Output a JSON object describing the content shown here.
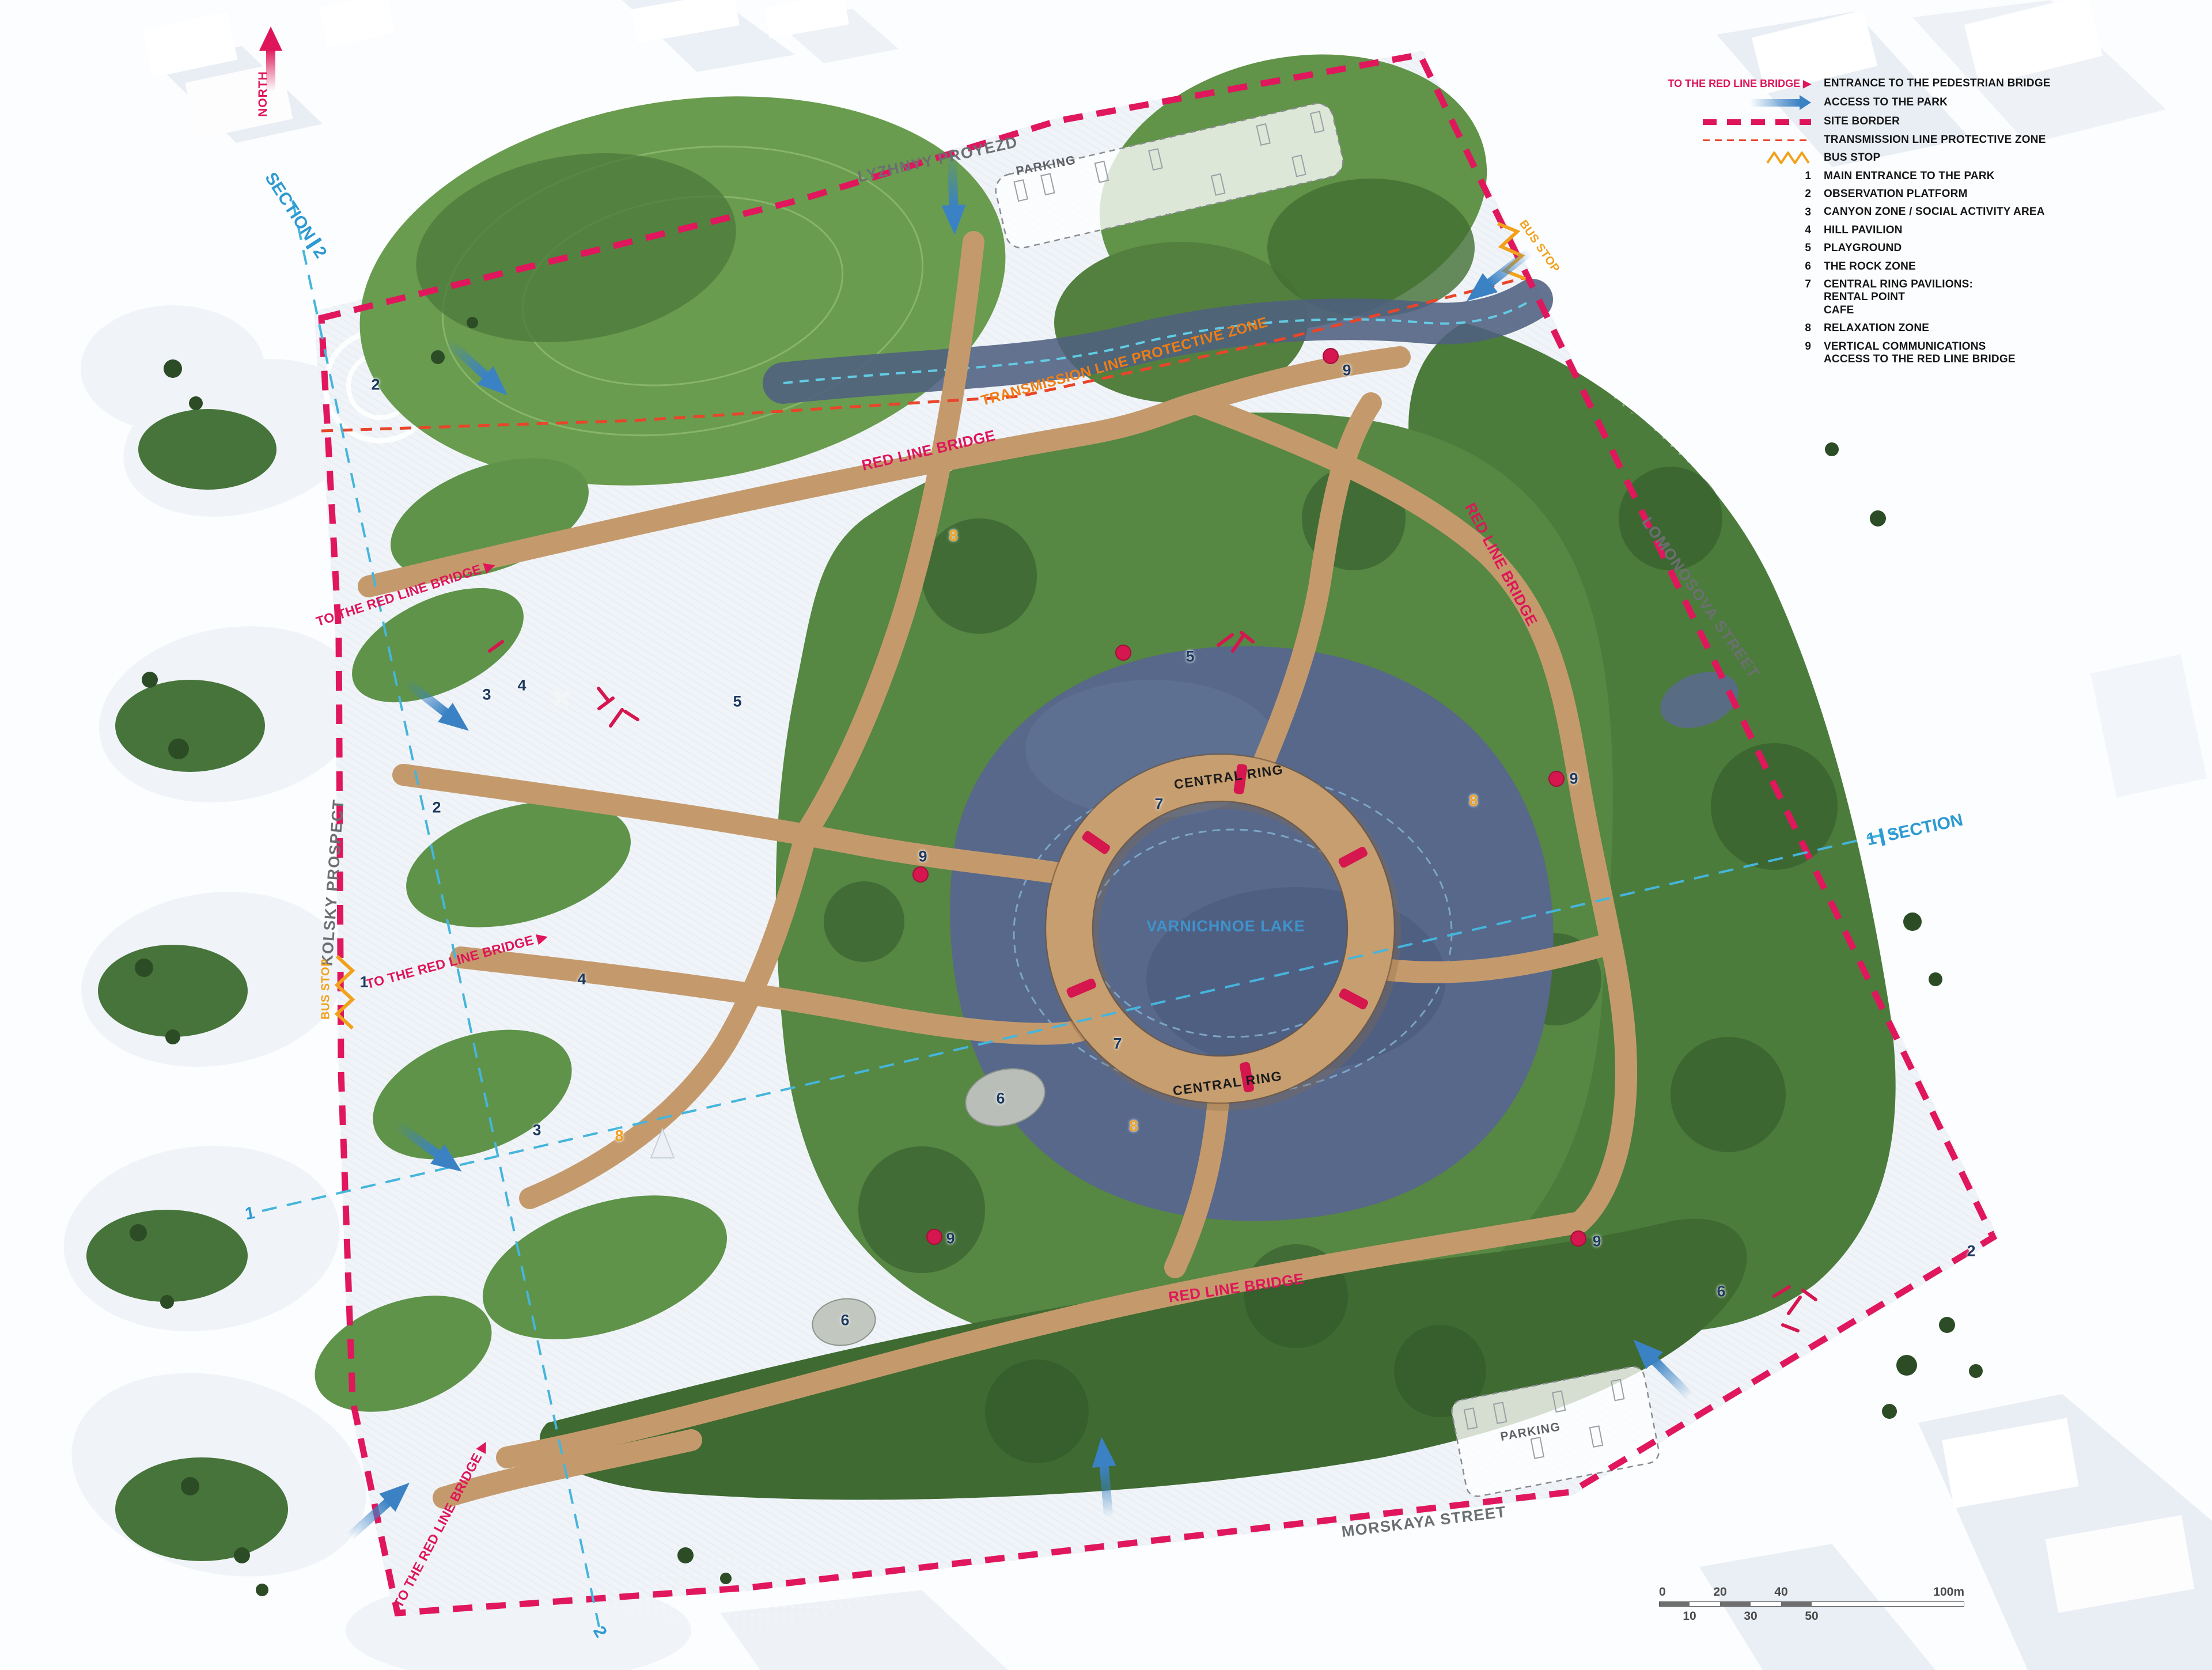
{
  "colors": {
    "accent_crimson": "#de1659",
    "accent_orange": "#f2a11b",
    "transmission_orange": "#ef7d15",
    "section_blue": "#2e9ad2",
    "access_arrow_blue": "#3b82c4",
    "marker_navy": "#1c3a60",
    "lake_fill": "#57688a",
    "path_wood": "#c49a6d",
    "street_gray": "#6c6f72"
  },
  "legend": {
    "key_rows": [
      {
        "key_label": "TO THE RED LINE BRIDGE ▶",
        "label": "ENTRANCE TO THE PEDESTRIAN BRIDGE"
      },
      {
        "label": "ACCESS TO THE PARK"
      },
      {
        "label": "SITE BORDER"
      },
      {
        "label": "TRANSMISSION LINE PROTECTIVE ZONE"
      },
      {
        "label": "BUS STOP"
      }
    ],
    "numbered": [
      {
        "n": "1",
        "label": "MAIN ENTRANCE TO THE PARK"
      },
      {
        "n": "2",
        "label": "OBSERVATION PLATFORM"
      },
      {
        "n": "3",
        "label": "CANYON ZONE / SOCIAL ACTIVITY AREA"
      },
      {
        "n": "4",
        "label": "HILL PAVILION"
      },
      {
        "n": "5",
        "label": "PLAYGROUND"
      },
      {
        "n": "6",
        "label": "THE ROCK ZONE"
      },
      {
        "n": "7",
        "label": "CENTRAL RING PAVILIONS:\nRENTAL POINT\nCAFE"
      },
      {
        "n": "8",
        "label": "RELAXATION ZONE"
      },
      {
        "n": "9",
        "label": "VERTICAL COMMUNICATIONS\nACCESS TO THE RED LINE BRIDGE"
      }
    ]
  },
  "streets": {
    "top": "LYZHNYY PROYEZD",
    "right": "LOMONOSOVA STREET",
    "bottom": "MORSKAYA STREET",
    "left": "KOLSKY PROSPECT"
  },
  "map": {
    "north": "NORTH",
    "lake": "VARNICHNOE LAKE",
    "central_ring": "CENTRAL RING",
    "red_line_bridge": "RED LINE BRIDGE",
    "to_bridge": "TO THE RED LINE BRIDGE ▶",
    "transmission": "TRANSMISSION LINE PROTECTIVE ZONE",
    "bus_stop": "BUS STOP",
    "parking": "PARKING",
    "section_word": "SECTION",
    "section1_num": "1",
    "section2_num": "2"
  },
  "markers": [
    {
      "n": "2"
    },
    {
      "n": "8"
    },
    {
      "n": "9"
    },
    {
      "n": "4"
    },
    {
      "n": "3"
    },
    {
      "n": "5"
    },
    {
      "n": "5"
    },
    {
      "n": "2"
    },
    {
      "n": "7"
    },
    {
      "n": "8"
    },
    {
      "n": "9"
    },
    {
      "n": "1"
    },
    {
      "n": "4"
    },
    {
      "n": "9"
    },
    {
      "n": "3"
    },
    {
      "n": "8"
    },
    {
      "n": "7"
    },
    {
      "n": "8"
    },
    {
      "n": "6"
    },
    {
      "n": "6"
    },
    {
      "n": "9"
    },
    {
      "n": "9"
    },
    {
      "n": "6"
    },
    {
      "n": "2"
    }
  ],
  "scalebar": {
    "top": [
      "0",
      "20",
      "40"
    ],
    "bottom": [
      "10",
      "30",
      "50"
    ],
    "end": "100m"
  }
}
